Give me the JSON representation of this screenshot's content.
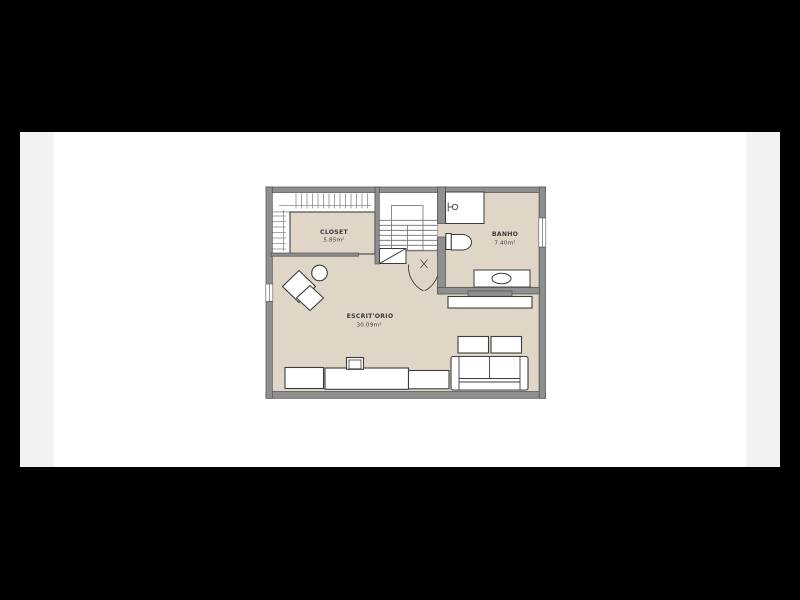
{
  "scene": {
    "background_color": "#000000",
    "page_background_color": "#f1f2f4",
    "canvas_color": "#ffffff"
  },
  "floorplan": {
    "rooms": [
      {
        "id": "closet",
        "name": "CLOSET",
        "area": "5.85m²"
      },
      {
        "id": "banho",
        "name": "BANHO",
        "area": "7.40m²"
      },
      {
        "id": "escritorio",
        "name": "ESCRIT'ORIO",
        "area": "30.09m²"
      }
    ],
    "fixtures": [
      "stairs",
      "double-swing-door",
      "wardrobe-hanger-rails",
      "shower",
      "shower-mixer",
      "toilet",
      "sink-vanity",
      "wall-console",
      "sofa",
      "coffee-tables",
      "desk-row",
      "monitor",
      "lounge-chairs",
      "side-table",
      "window-left",
      "window-right"
    ],
    "colors": {
      "wall": "#8f8f8f",
      "wall_edge": "#4f4f4f",
      "floor": "#e0d6c8",
      "fixture_outline": "#3c3c3c",
      "stair_line": "#6f6f6f",
      "hanger_line": "#8a8a8a"
    }
  }
}
